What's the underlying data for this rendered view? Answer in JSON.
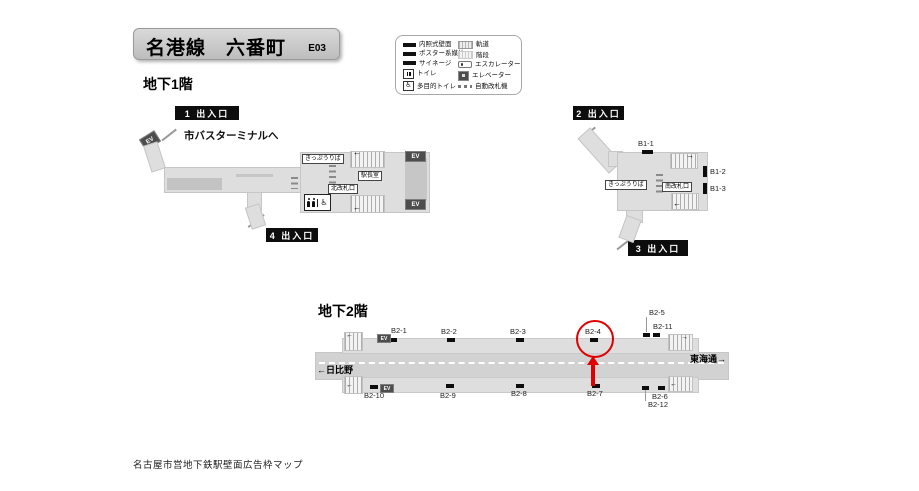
{
  "header": {
    "title": "名港線　六番町",
    "code": "E03"
  },
  "legend": {
    "left": [
      {
        "label": "内照式壁面",
        "icon": "lit-wall-icon"
      },
      {
        "label": "ポスター系媒体",
        "icon": "poster-media-icon"
      },
      {
        "label": "サイネージ",
        "icon": "signage-icon"
      },
      {
        "label": "トイレ",
        "icon": "toilet-icon"
      },
      {
        "label": "多目的トイレ",
        "icon": "accessible-toilet-icon"
      }
    ],
    "right": [
      {
        "label": "軌道",
        "icon": "track-icon"
      },
      {
        "label": "階段",
        "icon": "stairs-icon"
      },
      {
        "label": "エスカレーター",
        "icon": "escalator-icon"
      },
      {
        "label": "エレベーター",
        "icon": "elevator-icon"
      },
      {
        "label": "自動改札機",
        "icon": "ticket-gate-icon"
      }
    ]
  },
  "b1": {
    "heading": "地下1階",
    "exit1": "1 出入口",
    "exit2": "2 出入口",
    "exit3": "3 出入口",
    "exit4": "4 出入口",
    "bus": "市バスターミナルへ",
    "north": {
      "ticket": "きっぷうりば",
      "office": "駅長室",
      "gate": "北改札口"
    },
    "south": {
      "ticket": "きっぷうりば",
      "gate": "南改札口",
      "ads": [
        "B1-1",
        "B1-2",
        "B1-3"
      ]
    }
  },
  "b2": {
    "heading": "地下2階",
    "dir_left": "←日比野",
    "dir_right": "東海通→",
    "ads_top": [
      "B2-1",
      "B2-2",
      "B2-3",
      "B2-4",
      "B2-5",
      "B2-11"
    ],
    "ads_bottom": [
      "B2-10",
      "B2-9",
      "B2-8",
      "B2-7",
      "B2-6",
      "B2-12"
    ],
    "highlighted": "B2-4"
  },
  "ev": "EV",
  "icons": {
    "arrow_left": "←",
    "arrow_right": "→",
    "wheelchair": "♿"
  },
  "colors": {
    "highlight_red": "#e00000",
    "badge_black": "#0d0d0d",
    "plan_light": "#dedede",
    "plan_track": "#d2d2d2",
    "plan_dark": "#c3c3c3",
    "ev_gray": "#4d4d4d"
  },
  "footer": "名古屋市営地下鉄駅壁面広告枠マップ"
}
